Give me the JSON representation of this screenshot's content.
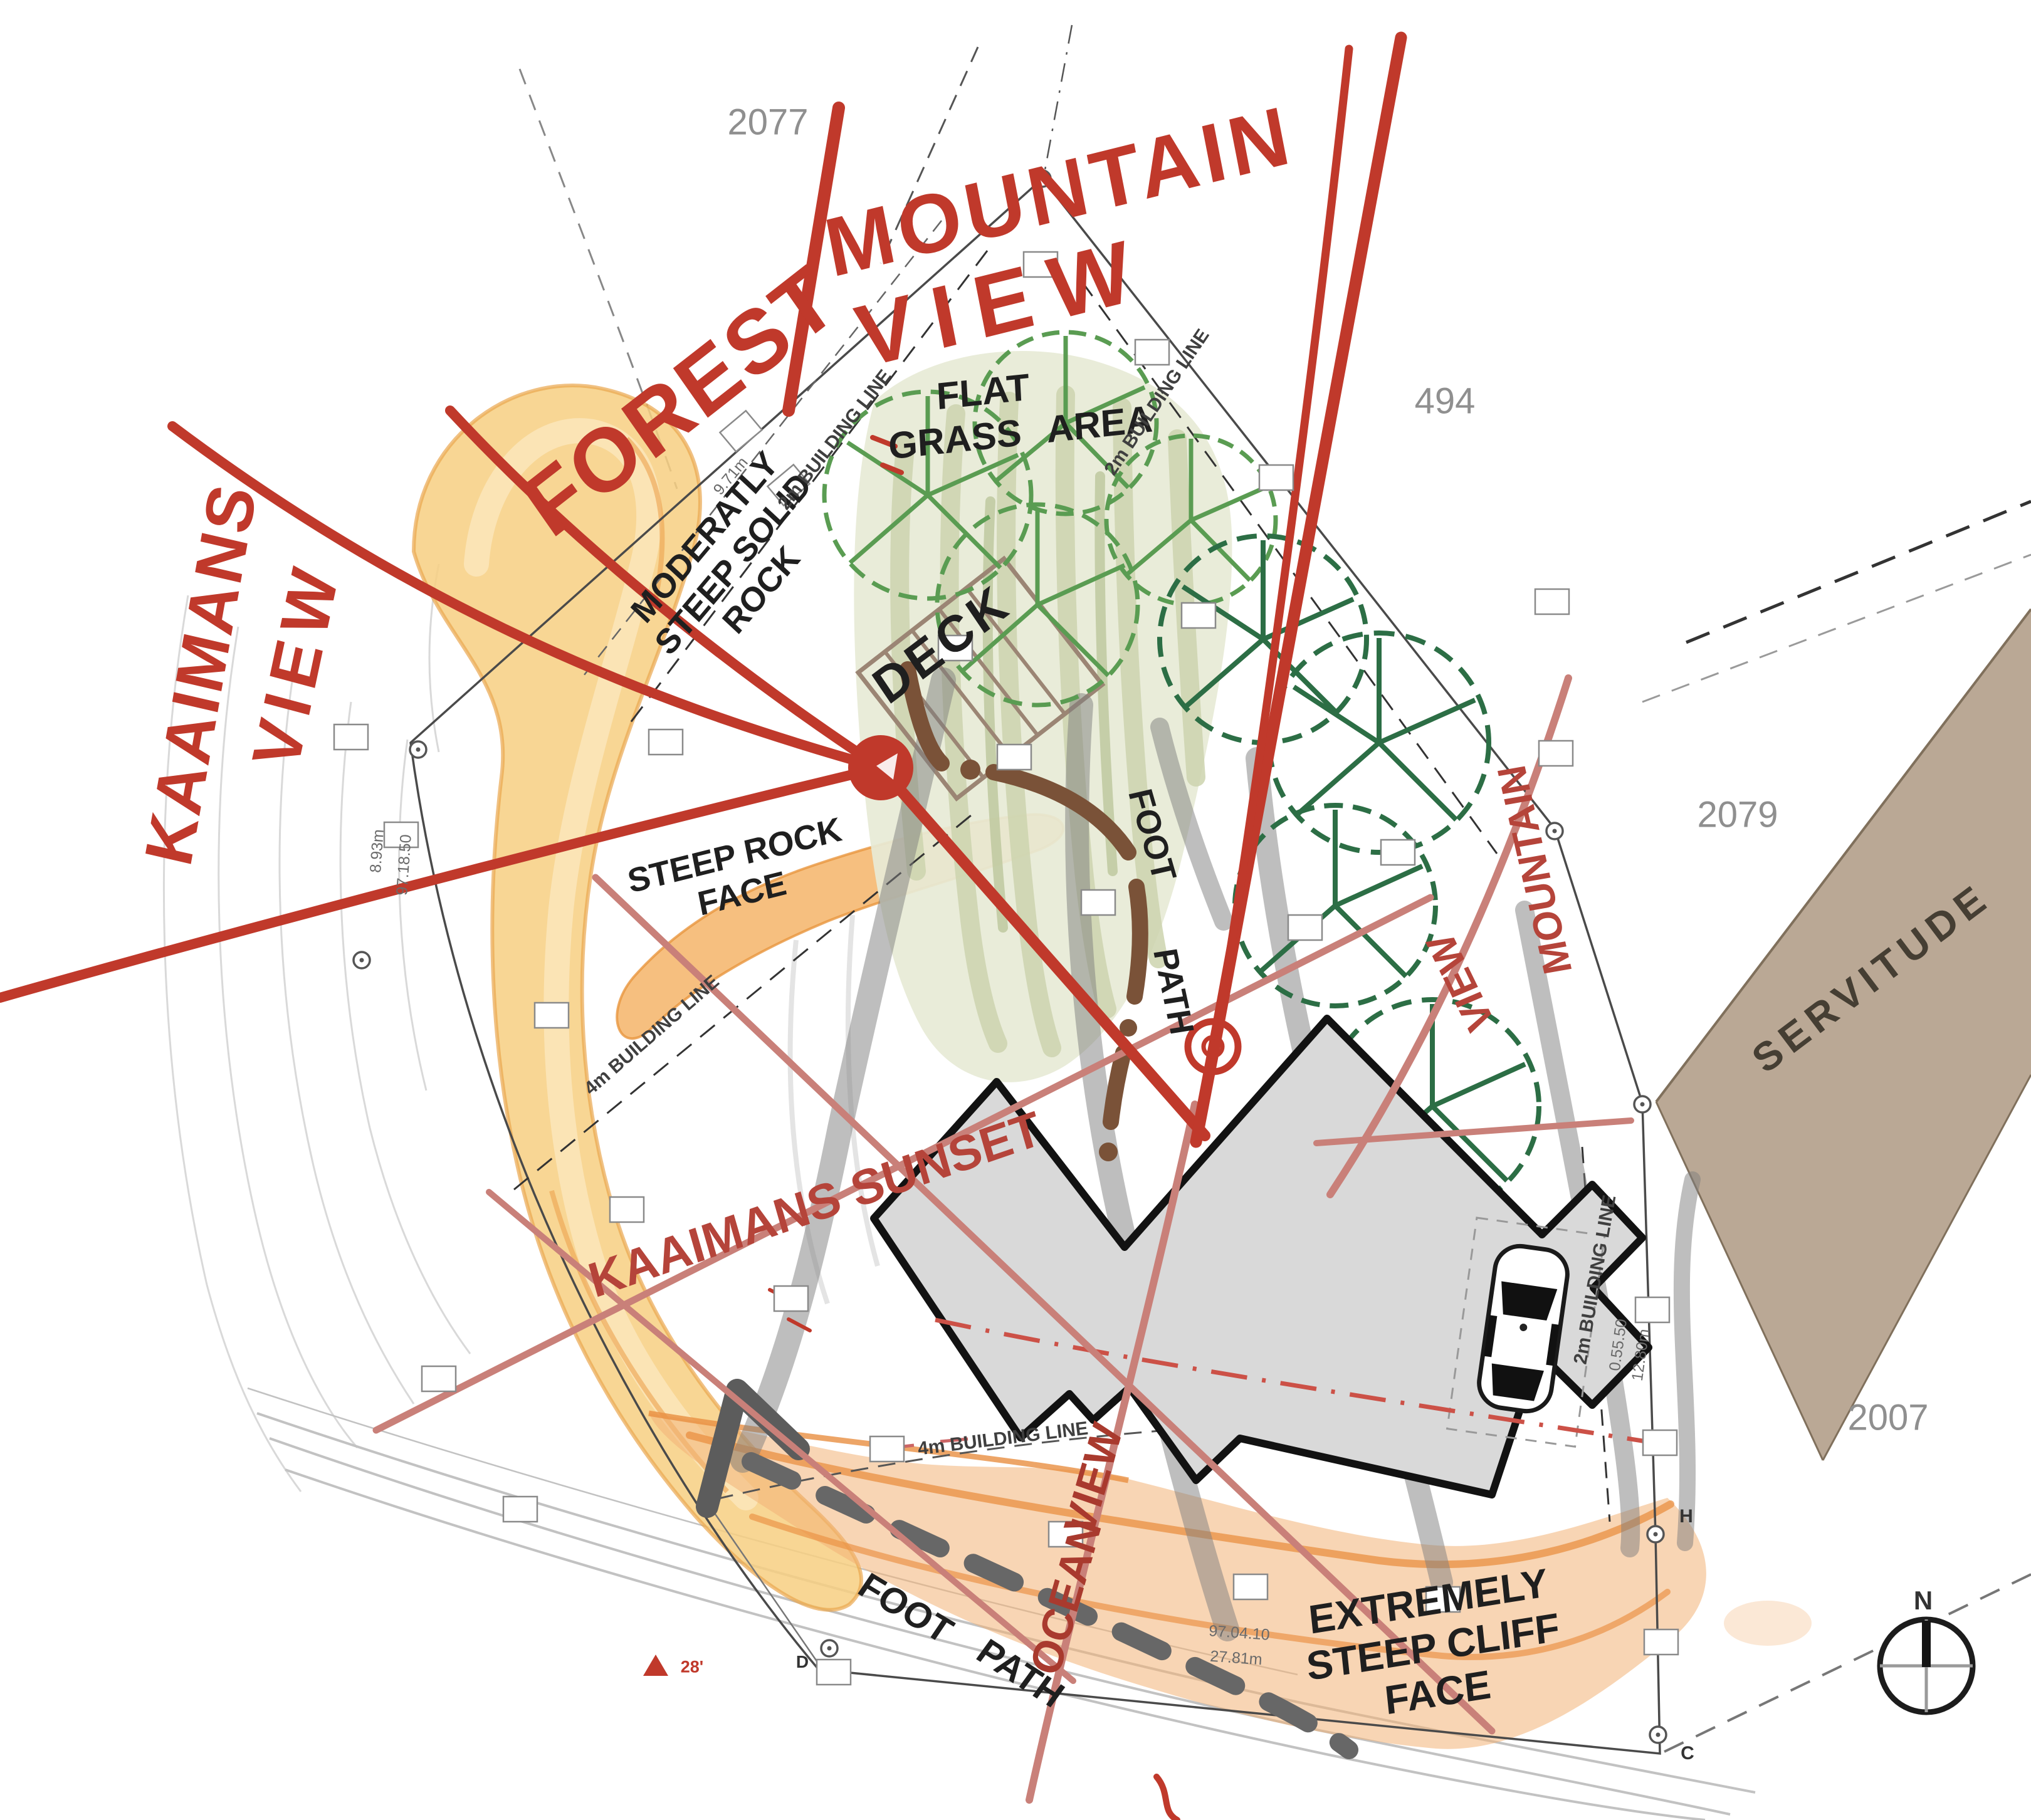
{
  "red_notes": {
    "forest": "FOREST",
    "mountain": "MOUNTAIN",
    "view": "VIEW",
    "kaaimans": "KAAIMANS",
    "kaaimans_view": "VIEW",
    "kaaimans_sunset": "KAAIMANS SUNSET",
    "mountain_view_word1": "MOUNTAIN",
    "mountain_view_word2": "VIEW",
    "ocean": "OCEAN",
    "ocean_view": "VIEW"
  },
  "site_notes": {
    "flat": "FLAT",
    "grass_area": "GRASS AREA",
    "deck": "DECK",
    "rock_line1": "MODERATLY",
    "rock_line2": "STEEP SOLID",
    "rock_line3": "ROCK",
    "steep_line1": "STEEP ROCK",
    "steep_line2": "FACE",
    "cliff_line1": "EXTREMELY",
    "cliff_line2": "STEEP CLIFF",
    "cliff_line3": "FACE",
    "footpath_upper_word1": "FOOT",
    "footpath_upper_word2": "PATH",
    "footpath_lower_word1": "FOOT",
    "footpath_lower_word2": "PATH"
  },
  "survey": {
    "erf_top": "2077",
    "erf_right": "494",
    "erf_mid": "2079",
    "erf_bottom": "2007",
    "servitude": "SERVITUDE",
    "bl_upper_left": "2m BUILDING LINE",
    "bl_upper_right": "2m BUILDING LINE",
    "bl_mid_left": "4m BUILDING LINE",
    "bl_bottom": "4m BUILDING LINE",
    "bl_right": "2m BUILDING LINE",
    "dim_bottom_a": "97.04.10",
    "dim_bottom_b": "27.81m",
    "dim_right_a": "0.55.50",
    "dim_right_b": "12.80m",
    "dim_left_a": "8.93m",
    "dim_left_b": "97.18.50",
    "dim_upper_left": "9.71m",
    "pt_h": "H",
    "pt_c": "C",
    "pt_d": "D",
    "mark_angle": "28'"
  },
  "compass": {
    "north": "N"
  },
  "colors": {
    "red_ink": "#c0392b",
    "pink_line": "#c98079",
    "orange_rock": "#f2a95c",
    "yellow_rock": "#f7cf81",
    "grass": "#e7ead6",
    "tree_dark": "#2c6e45",
    "tree_light": "#5a9c52",
    "servitude_tan": "#b4a18c",
    "house_fill": "#d9d9d9",
    "path_brown": "#7a5238"
  }
}
